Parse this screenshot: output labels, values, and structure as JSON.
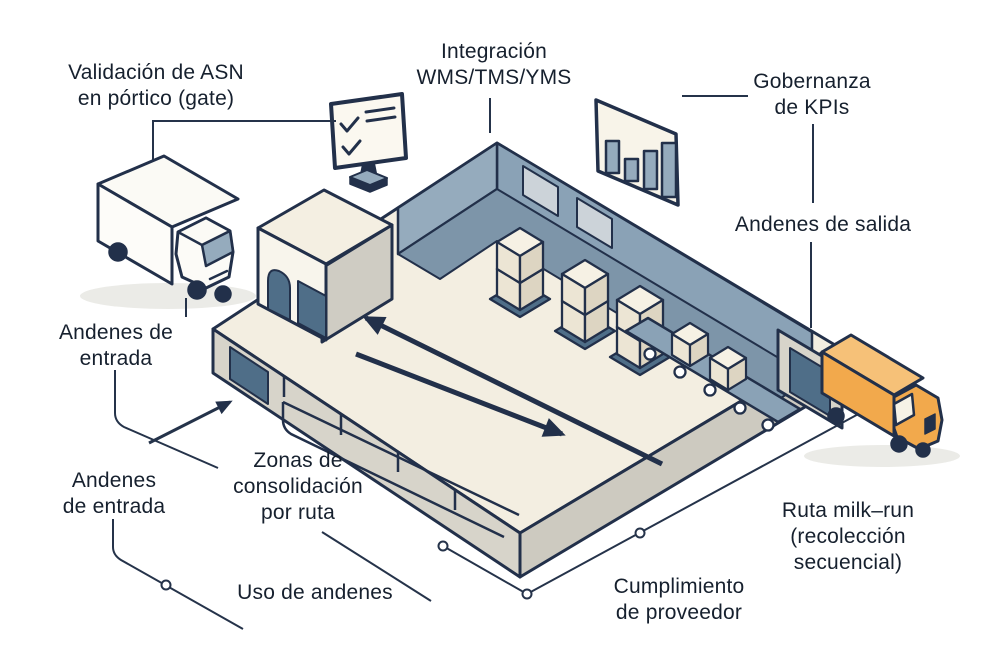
{
  "diagram": {
    "type": "isometric-crossdock-warehouse",
    "labels": {
      "asn_validation": {
        "lines": [
          "Validación de ASN",
          "en pórtico (gate)"
        ]
      },
      "integration": {
        "lines": [
          "Integración",
          "WMS/TMS/YMS"
        ]
      },
      "kpi_governance": {
        "lines": [
          "Gobernanza",
          "de KPIs"
        ]
      },
      "outbound_docks": {
        "lines": [
          "Andenes de salida"
        ]
      },
      "inbound_docks_upper": {
        "lines": [
          "Andenes de",
          "entrada"
        ]
      },
      "inbound_docks_lower": {
        "lines": [
          "Andenes",
          "de entrada"
        ]
      },
      "consolidation_zones": {
        "lines": [
          "Zonas de",
          "consolidación",
          "por ruta"
        ]
      },
      "dock_usage": {
        "lines": [
          "Uso de andenes"
        ]
      },
      "supplier_compliance": {
        "lines": [
          "Cumplimiento",
          "de proveedor"
        ]
      },
      "milk_run": {
        "lines": [
          "Ruta milk–run",
          "(recolección",
          "secuencial)"
        ]
      }
    },
    "icons": {
      "monitor_checklist": "monitor-with-checklist",
      "kpi_bar_panel": {
        "description": "panel-with-four-bars",
        "bar_heights_px": [
          32,
          22,
          38,
          54
        ]
      },
      "inbound_truck": "white-box-truck-at-gate",
      "outbound_truck": "orange-box-truck-at-outbound-dock",
      "gatehouse": "gate-portal-with-arched-door",
      "warehouse": "cross-dock-floor-with-flow-arrows",
      "pallet_stacks": "stacked-boxes-on-pallets",
      "conveyor": "roller-conveyor-with-boxes"
    },
    "colors": {
      "outline": "#22304a",
      "text": "#16202e",
      "cream": "#f3eee1",
      "wall_gray": "#d7d4ca",
      "blue_gray": "#8aa2b6",
      "blue_dark": "#4f6e88",
      "orange": "#f2a94c",
      "orange_light": "#f6c178",
      "background": "#ffffff"
    }
  }
}
